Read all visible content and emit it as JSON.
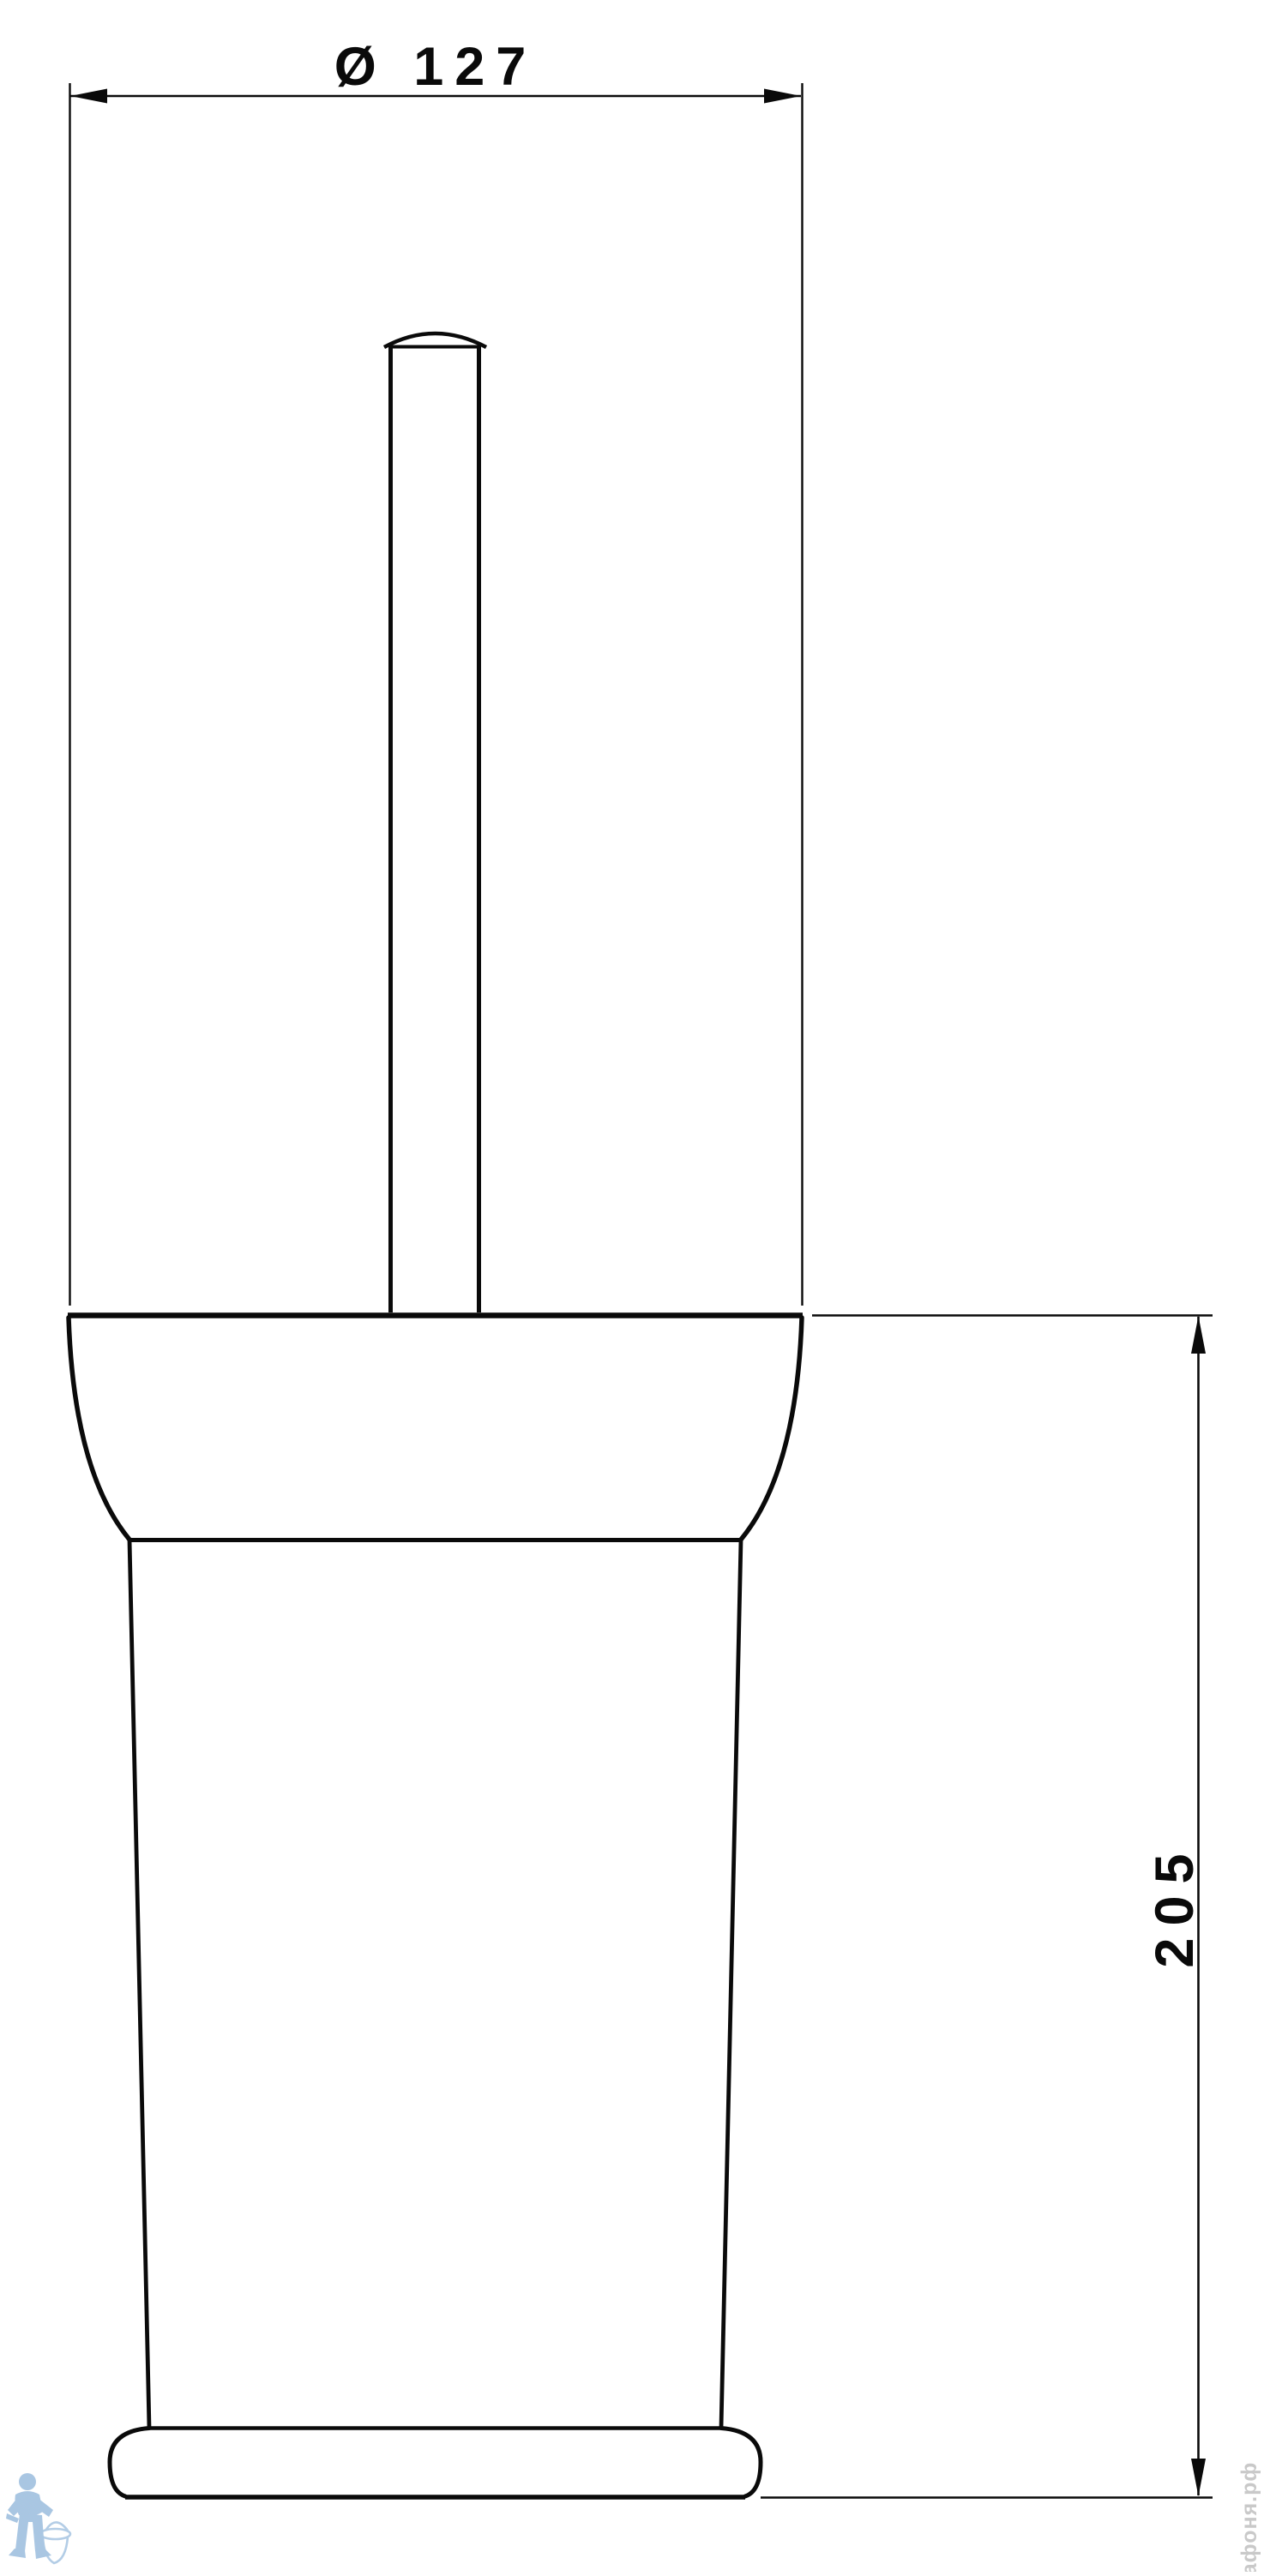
{
  "page": {
    "background_color": "#ffffff",
    "line_color": "#0a0a0a"
  },
  "drawing": {
    "kind": "technical dimension drawing",
    "diameter_dimension": {
      "label": "Ø 127"
    },
    "height_dimension": {
      "label": "205"
    }
  },
  "watermark": {
    "brand_text": "афоня.рф",
    "logo": "plumber-with-toilet-icon",
    "logo_color": "#a9c6e2",
    "text_color": "#c9c9c9"
  }
}
